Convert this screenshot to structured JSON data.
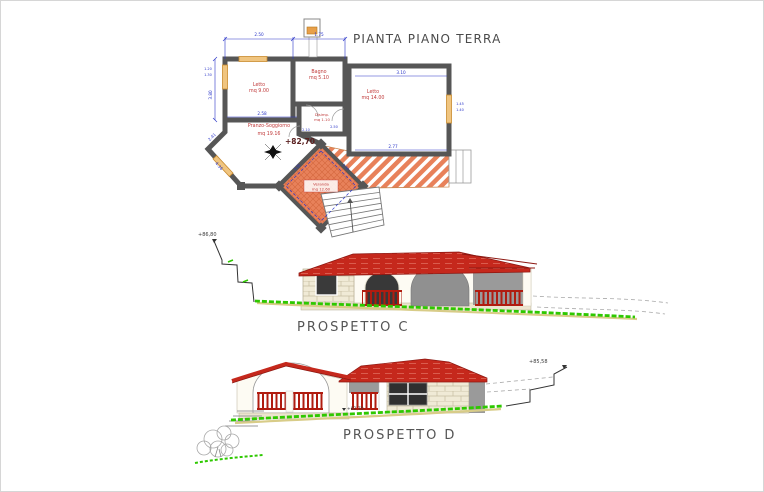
{
  "drawing": {
    "plan": {
      "title": "PIANTA PIANO TERRA",
      "level": "+82,70",
      "north_icon": "four-point-star-compass",
      "rooms": {
        "letto1": {
          "name": "Letto",
          "area": "mq 9.00"
        },
        "bagno": {
          "name": "Bagno",
          "area": "mq 5.10"
        },
        "disimp": {
          "name": "Disimp.",
          "area": "mq 1.10"
        },
        "letto2": {
          "name": "Letto",
          "area": "mq 14.00"
        },
        "pranzo": {
          "name": "Pranzo-Soggiorno",
          "area": "mq 19.16"
        },
        "veranda": {
          "name": "Veranda",
          "area": "mq 12.60"
        }
      },
      "dims": {
        "letto1_width": "2.50",
        "bagno_width": "1.75",
        "letto2_width": "3.10",
        "letto2_lower": "2.77",
        "pranzo_width": "2.58",
        "wall_left_height": "3.80",
        "diag_upper": "2.41",
        "diag_lower": "4.36",
        "window_left_a": "1.20",
        "window_left_b": "1.30",
        "window_right_a": "1.45",
        "window_right_b": "1.40",
        "disimp_a": "2.10",
        "disimp_b": "2.50",
        "veranda_a": "3.95",
        "veranda_b": "2.90"
      }
    },
    "elevation_c": {
      "label": "PROSPETTO C",
      "level_top": "+86,80"
    },
    "elevation_d": {
      "label": "PROSPETTO D",
      "level_top": "+85,58",
      "level_ground": "+82,70"
    },
    "colors": {
      "wall_gray": "#565656",
      "dimension_blue": "#2a35c8",
      "room_label_red": "#c03a3a",
      "window_orange": "#d79a4b",
      "veranda_orange": "#e8815a",
      "roof_red": "#c5281c",
      "stone_beige": "#f0ead6",
      "shadow_gray": "#9a9a9a",
      "grass_green": "#2ec800",
      "sand_yellow": "#d8cc88"
    }
  }
}
